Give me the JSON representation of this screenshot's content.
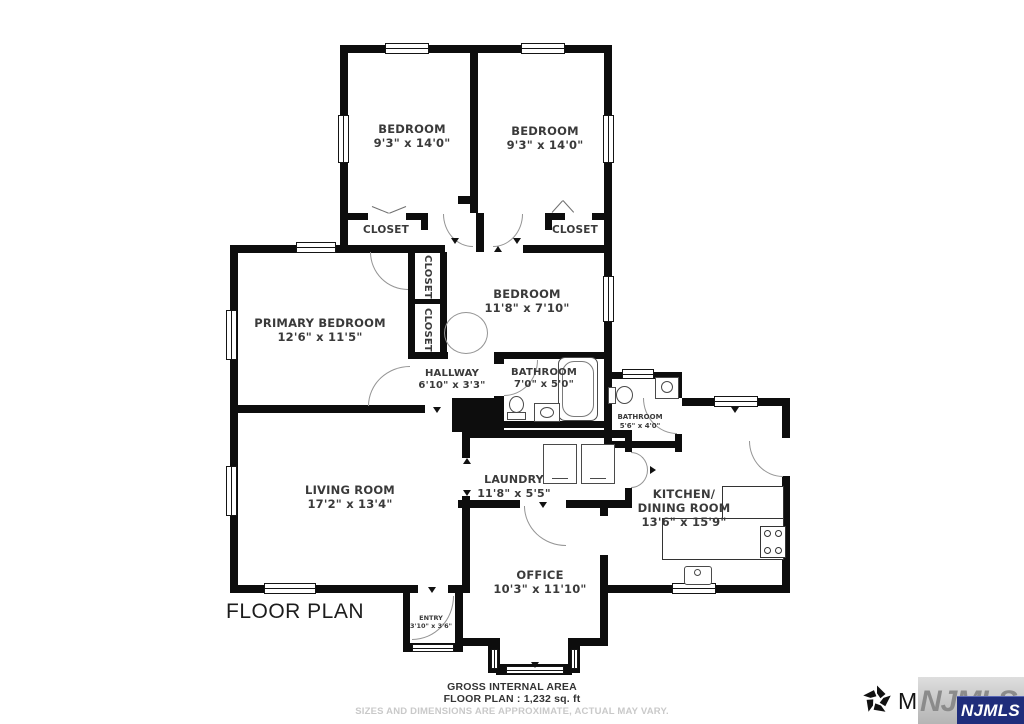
{
  "title": "FLOOR PLAN",
  "rooms": {
    "bedroom1": {
      "name": "BEDROOM",
      "dims": "9'3\" x 14'0\""
    },
    "bedroom2": {
      "name": "BEDROOM",
      "dims": "9'3\" x 14'0\""
    },
    "closet_top_left": {
      "name": "CLOSET"
    },
    "closet_top_right": {
      "name": "CLOSET"
    },
    "closet_mid_upper": {
      "name": "CLOSET"
    },
    "closet_mid_lower": {
      "name": "CLOSET"
    },
    "primary_bedroom": {
      "name": "PRIMARY BEDROOM",
      "dims": "12'6\" x 11'5\""
    },
    "bedroom3": {
      "name": "BEDROOM",
      "dims": "11'8\" x 7'10\""
    },
    "hallway": {
      "name": "HALLWAY",
      "dims": "6'10\" x 3'3\""
    },
    "bathroom1": {
      "name": "BATHROOM",
      "dims": "7'0\" x 5'0\""
    },
    "bathroom2": {
      "name": "BATHROOM",
      "dims": "5'6\" x 4'0\""
    },
    "living_room": {
      "name": "LIVING ROOM",
      "dims": "17'2\" x 13'4\""
    },
    "laundry": {
      "name": "LAUNDRY",
      "dims": "11'8\" x 5'5\""
    },
    "kitchen": {
      "name": "KITCHEN/\nDINING ROOM",
      "dims": "13'6\" x 15'9\""
    },
    "office": {
      "name": "OFFICE",
      "dims": "10'3\" x 11'10\""
    },
    "entry": {
      "name": "ENTRY",
      "dims": "3'10\" x 3'6\""
    }
  },
  "footer": {
    "line1": "GROSS INTERNAL AREA",
    "line2": "FLOOR PLAN : 1,232 sq. ft",
    "disclaimer": "SIZES AND DIMENSIONS ARE APPROXIMATE, ACTUAL MAY VARY."
  },
  "branding": {
    "matterport_label": "Matterport",
    "njmls_badge": "NJMLS",
    "njmls_ghost": "NJMLS",
    "badge_color": "#1f2d7b",
    "wall_color": "#0d0d0d",
    "label_color": "#3a3a3a"
  }
}
